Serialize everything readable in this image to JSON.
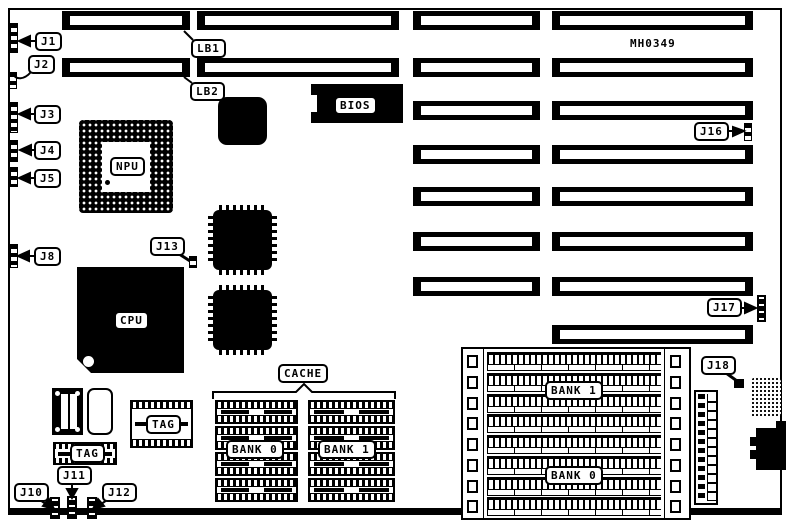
{
  "board": {
    "part_number": "MH0349"
  },
  "colors": {
    "ink": "#000000",
    "paper": "#ffffff"
  },
  "callouts": {
    "j1": "J1",
    "j2": "J2",
    "j3": "J3",
    "j4": "J4",
    "j5": "J5",
    "j8": "J8",
    "j10": "J10",
    "j11": "J11",
    "j12": "J12",
    "j13": "J13",
    "j16": "J16",
    "j17": "J17",
    "j18": "J18",
    "lb1": "LB1",
    "lb2": "LB2"
  },
  "chips": {
    "npu": "NPU",
    "cpu": "CPU",
    "bios": "BIOS"
  },
  "cache": {
    "title": "CACHE",
    "bank0": "BANK 0",
    "bank1": "BANK 1",
    "tag_a": "TAG",
    "tag_b": "TAG"
  },
  "memory": {
    "bank1": "BANK 1",
    "bank0": "BANK 0"
  }
}
